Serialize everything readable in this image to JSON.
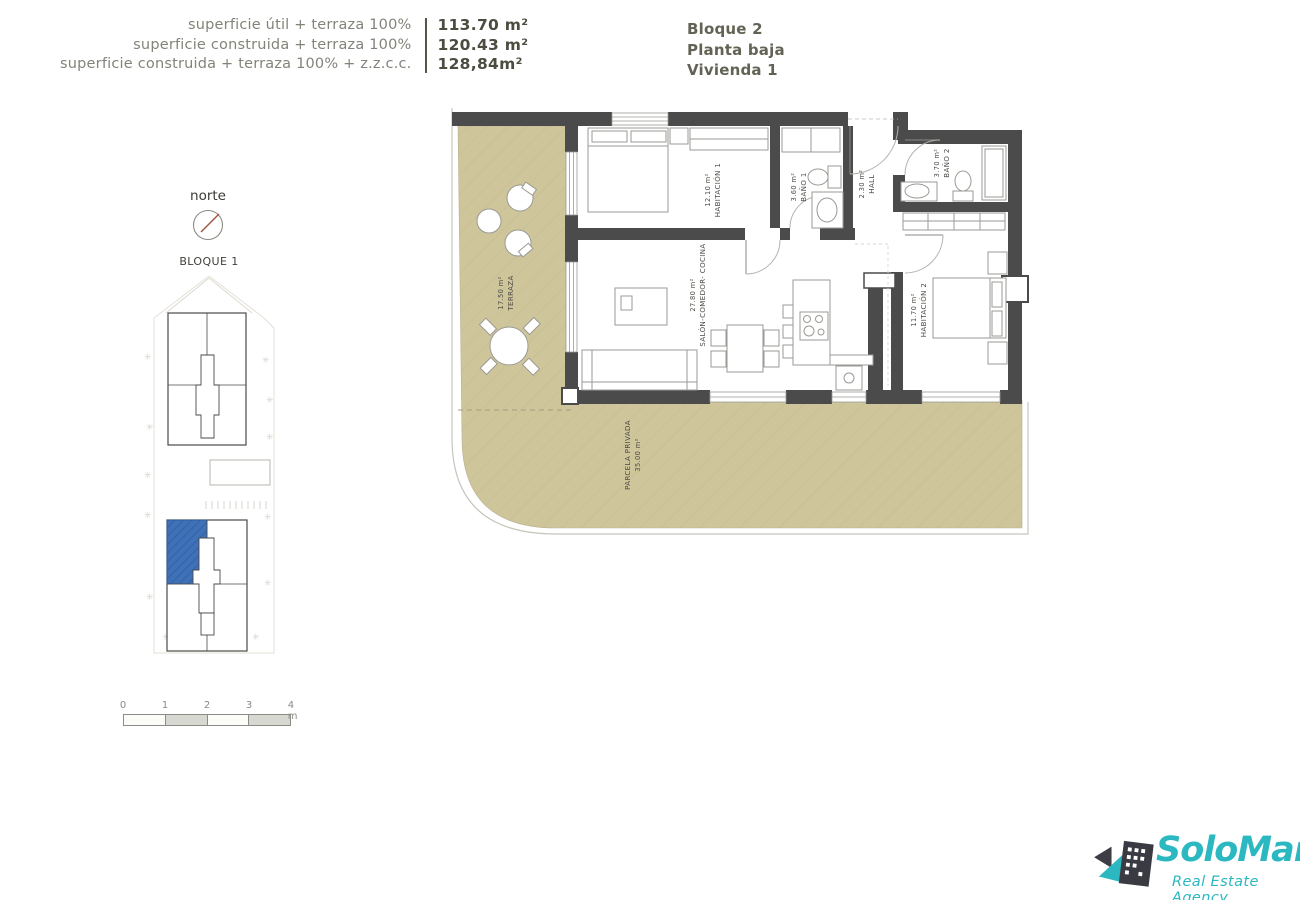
{
  "header": {
    "measurements": [
      {
        "label": "superficie útil + terraza 100%",
        "value": "113.70 m²"
      },
      {
        "label": "superficie construida + terraza 100%",
        "value": "120.43 m²"
      },
      {
        "label": "superficie construida + terraza 100% + z.z.c.c.",
        "value": "128,84m²"
      }
    ],
    "block": "Bloque 2",
    "floor": "Planta baja",
    "unit": "Vivienda 1"
  },
  "compass": {
    "label": "norte"
  },
  "site_plan": {
    "label": "BLOQUE 1"
  },
  "scale_bar": {
    "ticks": [
      "0",
      "1",
      "2",
      "3",
      "4 m"
    ]
  },
  "rooms": {
    "terraza": {
      "area": "17.50 m²",
      "name": "TERRAZA"
    },
    "habitacion1": {
      "area": "12.10 m²",
      "name": "HABITACIÓN 1"
    },
    "bano1": {
      "area": "3.60 m²",
      "name": "BAÑO 1"
    },
    "hall": {
      "area": "2.30 m²",
      "name": "HALL"
    },
    "bano2": {
      "area": "3.70 m²",
      "name": "BAÑO 2"
    },
    "habitacion2": {
      "area": "11.70 m²",
      "name": "HABITACIÓN 2"
    },
    "salon": {
      "area": "27.80 m²",
      "name": "SALÓN-COMEDOR- COCINA"
    },
    "parcela": {
      "area": "35.00 m²",
      "name": "PARCELA PRIVADA"
    }
  },
  "logo": {
    "brand": "SoloMar",
    "tagline": "Real Estate Agency"
  },
  "colors": {
    "wall": "#4b4b4b",
    "terrace_tan": "#cfc59b",
    "highlight_blue": "#3e71b8",
    "brand_teal": "#2bb8c0",
    "label_olive": "#83837a",
    "value_olive": "#4c4c41"
  }
}
